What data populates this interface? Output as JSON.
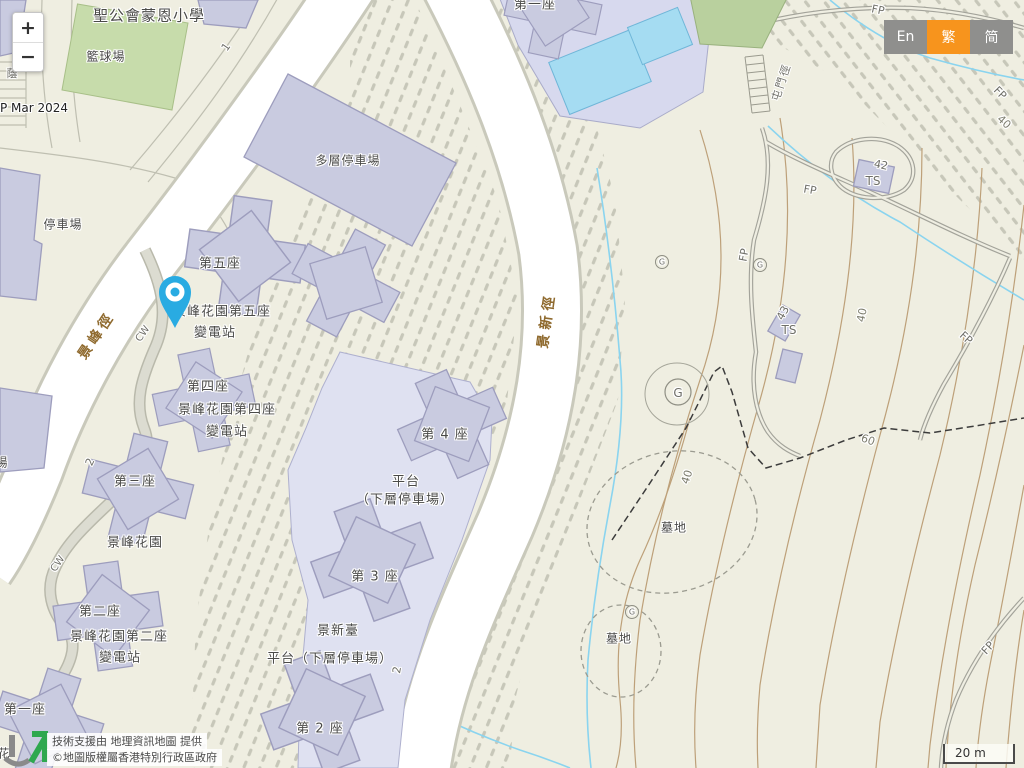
{
  "palette": {
    "map_bg": "#efeee1",
    "building": "#c9cbe0",
    "building_outline": "#9d9dbd",
    "platform": "#dfe1f1",
    "road_white": "#ffffff",
    "court_green": "#c7dcab",
    "pool_blue": "#a5dcf2",
    "stream_blue": "#8ad4ef",
    "contour_brown": "#bda079",
    "hatch_gray": "#c7c7b9",
    "pin_blue": "#29abe2",
    "accent_orange": "#f7941d",
    "lang_gray": "#8f8f8d",
    "label_dark": "#4a4a48",
    "road_label_brown": "#8f6a2e"
  },
  "controls": {
    "zoom_in": "+",
    "zoom_out": "−"
  },
  "language": {
    "english": "En",
    "traditional": "繁",
    "simplified": "简"
  },
  "scale_bar": {
    "label": "20 m"
  },
  "attribution": {
    "line1": "技術支援由 地理資訊地圖 提供",
    "line2": "©地圖版權屬香港特別行政區政府"
  },
  "map": {
    "labels": [
      {
        "name": "school-label",
        "text": "聖公會蒙恩小學",
        "x": 149,
        "y": 15,
        "rot": 0,
        "cls": "place",
        "size": 15
      },
      {
        "name": "basketball-court-label",
        "text": "籃球場",
        "x": 106,
        "y": 56,
        "rot": 0,
        "cls": "place",
        "size": 12
      },
      {
        "name": "map-date",
        "text": "P Mar 2024",
        "x": 34,
        "y": 108,
        "rot": 0,
        "cls": "dark",
        "size": 12
      },
      {
        "name": "carpark-label",
        "text": "停車場",
        "x": 63,
        "y": 224,
        "rot": 0,
        "cls": "place",
        "size": 12
      },
      {
        "name": "multistorey-carpark-label",
        "text": "多層停車場",
        "x": 348,
        "y": 160,
        "rot": 0,
        "cls": "place",
        "size": 12
      },
      {
        "name": "block5-label",
        "text": "第五座",
        "x": 220,
        "y": 262,
        "rot": 0,
        "cls": "place",
        "size": 13
      },
      {
        "name": "block5-substation-line1",
        "text": "景峰花園第五座",
        "x": 222,
        "y": 310,
        "rot": 0,
        "cls": "place",
        "size": 13
      },
      {
        "name": "block5-substation-line2",
        "text": "變電站",
        "x": 215,
        "y": 331,
        "rot": 0,
        "cls": "place",
        "size": 13
      },
      {
        "name": "block4-label",
        "text": "第四座",
        "x": 208,
        "y": 385,
        "rot": 0,
        "cls": "place",
        "size": 13
      },
      {
        "name": "block4-substation-line1",
        "text": "景峰花園第四座",
        "x": 227,
        "y": 408,
        "rot": 0,
        "cls": "place",
        "size": 13
      },
      {
        "name": "block4-substation-line2",
        "text": "變電站",
        "x": 227,
        "y": 430,
        "rot": 0,
        "cls": "place",
        "size": 13
      },
      {
        "name": "block3-label",
        "text": "第三座",
        "x": 135,
        "y": 480,
        "rot": 0,
        "cls": "place",
        "size": 13
      },
      {
        "name": "estate-label",
        "text": "景峰花園",
        "x": 135,
        "y": 541,
        "rot": 0,
        "cls": "place",
        "size": 13
      },
      {
        "name": "block2-label",
        "text": "第二座",
        "x": 100,
        "y": 610,
        "rot": 0,
        "cls": "place",
        "size": 13
      },
      {
        "name": "block2-substation-line1",
        "text": "景峰花園第二座",
        "x": 119,
        "y": 635,
        "rot": 0,
        "cls": "place",
        "size": 13
      },
      {
        "name": "block2-substation-line2",
        "text": "變電站",
        "x": 120,
        "y": 656,
        "rot": 0,
        "cls": "place",
        "size": 13
      },
      {
        "name": "block1-label",
        "text": "第一座",
        "x": 25,
        "y": 708,
        "rot": 0,
        "cls": "place",
        "size": 13
      },
      {
        "name": "tower4-label",
        "text": "第 4 座",
        "x": 445,
        "y": 433,
        "rot": 0,
        "cls": "place",
        "size": 13
      },
      {
        "name": "podium1-line1",
        "text": "平台",
        "x": 406,
        "y": 480,
        "rot": 0,
        "cls": "place",
        "size": 13
      },
      {
        "name": "podium1-line2",
        "text": "（下層停車場）",
        "x": 405,
        "y": 498,
        "rot": 0,
        "cls": "place",
        "size": 13
      },
      {
        "name": "tower3-label",
        "text": "第 3 座",
        "x": 375,
        "y": 575,
        "rot": 0,
        "cls": "place",
        "size": 13
      },
      {
        "name": "kingsfield-terrace-label",
        "text": "景新臺",
        "x": 338,
        "y": 629,
        "rot": 0,
        "cls": "place",
        "size": 13
      },
      {
        "name": "podium2-label",
        "text": "平台（下層停車場）",
        "x": 330,
        "y": 657,
        "rot": 0,
        "cls": "place",
        "size": 13
      },
      {
        "name": "tower2-label",
        "text": "第 2 座",
        "x": 320,
        "y": 727,
        "rot": 0,
        "cls": "place",
        "size": 13
      },
      {
        "name": "top-block1-label",
        "text": "第一座",
        "x": 535,
        "y": 3,
        "rot": 0,
        "cls": "place",
        "size": 13
      },
      {
        "name": "cemetery-label-1",
        "text": "墓地",
        "x": 674,
        "y": 527,
        "rot": 0,
        "cls": "place",
        "size": 12
      },
      {
        "name": "cemetery-label-2",
        "text": "墓地",
        "x": 619,
        "y": 638,
        "rot": 0,
        "cls": "place",
        "size": 12
      },
      {
        "name": "king-fung-path-label",
        "text": "景峰徑",
        "x": 96,
        "y": 335,
        "rot": -56,
        "cls": "road",
        "size": 14,
        "ls": 4
      },
      {
        "name": "king-san-path-label",
        "text": "景新徑",
        "x": 546,
        "y": 320,
        "rot": -82,
        "cls": "road",
        "size": 14,
        "ls": 5
      },
      {
        "name": "tuen-mun-trail-label",
        "text": "屯門徑",
        "x": 781,
        "y": 82,
        "rot": -72,
        "cls": "gray",
        "size": 11,
        "ls": 2
      },
      {
        "name": "cw-label-1",
        "text": "CW",
        "x": 143,
        "y": 334,
        "rot": -55,
        "cls": "gray",
        "size": 10
      },
      {
        "name": "cw-label-2",
        "text": "CW",
        "x": 58,
        "y": 564,
        "rot": -55,
        "cls": "gray",
        "size": 10
      },
      {
        "name": "fp-label-1",
        "text": "FP",
        "x": 878,
        "y": 10,
        "rot": 12,
        "cls": "gray",
        "size": 11
      },
      {
        "name": "fp-label-2",
        "text": "FP",
        "x": 1000,
        "y": 93,
        "rot": 45,
        "cls": "gray",
        "size": 11
      },
      {
        "name": "fp-label-3",
        "text": "FP",
        "x": 810,
        "y": 190,
        "rot": 10,
        "cls": "gray",
        "size": 11
      },
      {
        "name": "fp-label-4",
        "text": "FP",
        "x": 744,
        "y": 255,
        "rot": -80,
        "cls": "gray",
        "size": 11
      },
      {
        "name": "fp-label-5",
        "text": "FP",
        "x": 966,
        "y": 338,
        "rot": 42,
        "cls": "gray",
        "size": 11
      },
      {
        "name": "fp-label-6",
        "text": "FP",
        "x": 988,
        "y": 648,
        "rot": -48,
        "cls": "gray",
        "size": 11
      },
      {
        "name": "road-number-1",
        "text": "1",
        "x": 226,
        "y": 47,
        "rot": -55,
        "cls": "gray",
        "size": 11
      },
      {
        "name": "road-number-2a",
        "text": "2",
        "x": 90,
        "y": 462,
        "rot": -65,
        "cls": "gray",
        "size": 11
      },
      {
        "name": "road-number-2b",
        "text": "2",
        "x": 397,
        "y": 670,
        "rot": -80,
        "cls": "gray",
        "size": 11
      },
      {
        "name": "contour-40-a",
        "text": "40",
        "x": 1004,
        "y": 122,
        "rot": 42,
        "cls": "contour",
        "size": 11
      },
      {
        "name": "contour-40-b",
        "text": "40",
        "x": 862,
        "y": 315,
        "rot": -78,
        "cls": "contour",
        "size": 11
      },
      {
        "name": "contour-40-c",
        "text": "40",
        "x": 687,
        "y": 477,
        "rot": -72,
        "cls": "contour",
        "size": 11
      },
      {
        "name": "contour-60",
        "text": "60",
        "x": 868,
        "y": 440,
        "rot": 20,
        "cls": "contour",
        "size": 11
      },
      {
        "name": "spot-height-42",
        "text": "42",
        "x": 881,
        "y": 165,
        "rot": 12,
        "cls": "gray",
        "size": 11
      },
      {
        "name": "ts-label-1",
        "text": "TS",
        "x": 873,
        "y": 181,
        "rot": 0,
        "cls": "gray",
        "size": 12
      },
      {
        "name": "spot-height-43",
        "text": "43",
        "x": 783,
        "y": 313,
        "rot": -62,
        "cls": "gray",
        "size": 11
      },
      {
        "name": "ts-label-2",
        "text": "TS",
        "x": 789,
        "y": 330,
        "rot": 0,
        "cls": "gray",
        "size": 12
      },
      {
        "name": "grave-symbol-large",
        "text": "G",
        "x": 678,
        "y": 393,
        "rot": 0,
        "cls": "gray",
        "size": 12
      },
      {
        "name": "grave-symbol-small-1",
        "text": "G",
        "x": 662,
        "y": 262,
        "rot": 0,
        "cls": "gray",
        "size": 8
      },
      {
        "name": "grave-symbol-small-2",
        "text": "G",
        "x": 760,
        "y": 265,
        "rot": 0,
        "cls": "gray",
        "size": 8
      },
      {
        "name": "grave-symbol-small-3",
        "text": "G",
        "x": 632,
        "y": 612,
        "rot": 0,
        "cls": "gray",
        "size": 8
      },
      {
        "name": "partial-char-top-left",
        "text": "蔭",
        "x": 12,
        "y": 73,
        "rot": 0,
        "cls": "gray",
        "size": 11
      },
      {
        "name": "partial-char-mid-left",
        "text": "場",
        "x": 2,
        "y": 462,
        "rot": 0,
        "cls": "place",
        "size": 12
      },
      {
        "name": "partial-char-bottom-left",
        "text": "花",
        "x": 4,
        "y": 753,
        "rot": 0,
        "cls": "place",
        "size": 12
      }
    ]
  }
}
